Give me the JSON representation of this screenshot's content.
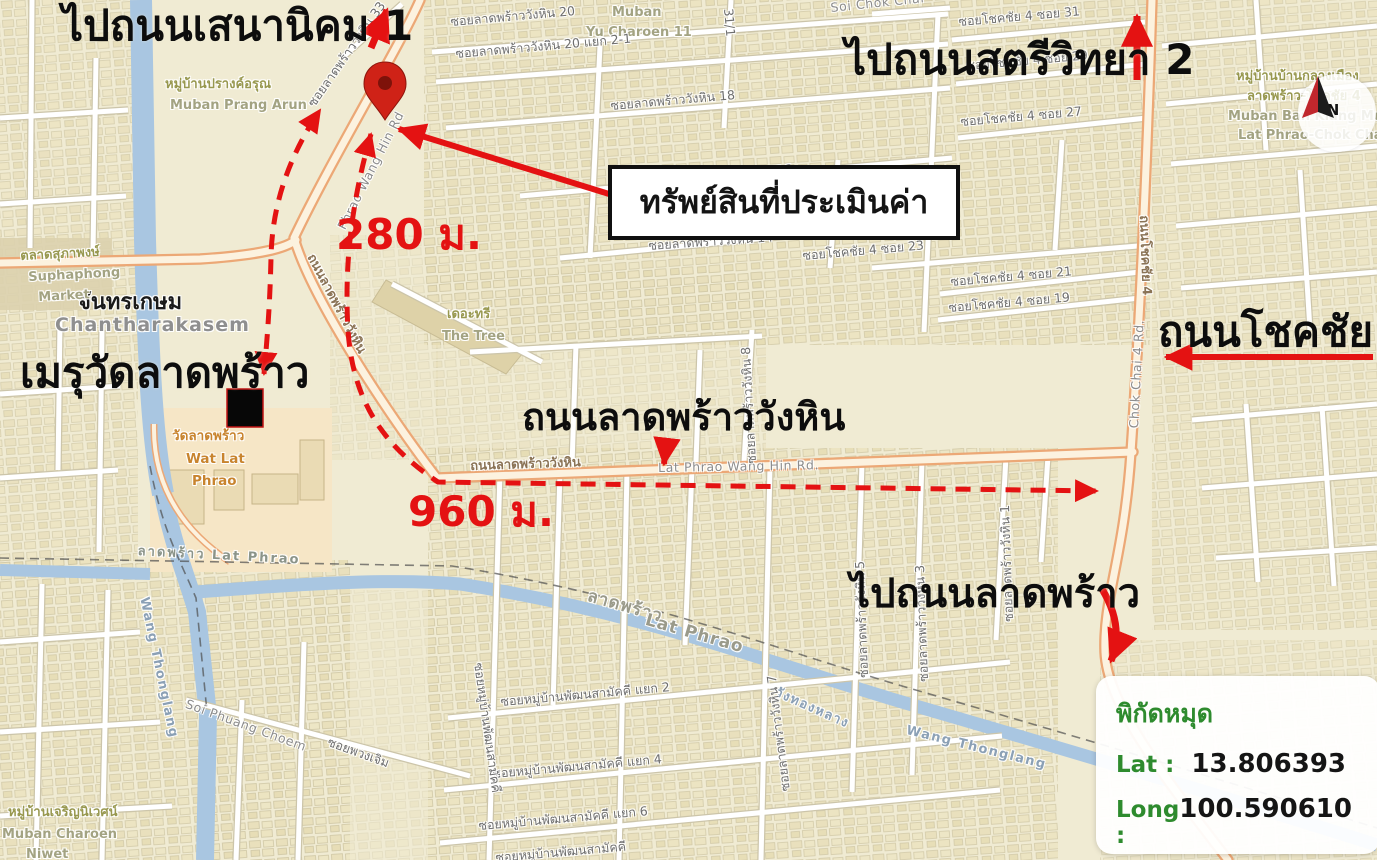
{
  "annotations": {
    "to_sena_nikhom_1": "ไปถนนเสนานิคม 1",
    "to_satri_witthaya_2": "ไปถนนสตรีวิทยา 2",
    "appraised_property": "ทรัพย์สินที่ประเมินค่า",
    "crematorium_wat_lat_phrao": "เมรุวัดลาดพร้าว",
    "lat_phrao_wang_hin_road_big": "ถนนลาดพร้าววังหิน",
    "chok_chai_4_road_big": "ถนนโชคชัย 4",
    "to_lat_phrao_road": "ไปถนนลาดพร้าว",
    "distance_to_crematorium": "280 ม.",
    "distance_to_chok_chai_4": "960 ม."
  },
  "coordinate_panel": {
    "title": "พิกัดหมุด",
    "lat_label": "Lat :",
    "lat_value": "13.806393",
    "long_label": "Long :",
    "long_value": "100.590610"
  },
  "compass": {
    "north_label": "N"
  },
  "colors": {
    "annotation_red": "#e41212",
    "coordinate_green": "#2e8b2e",
    "map_background": "#f0ebd3",
    "canal_blue": "#a9c6e1",
    "main_road_casing": "#eca876",
    "pin_red": "#cf2217"
  },
  "street_labels": [
    {
      "t": "ซอยลาดพร้าววังหิน 20",
      "x": 450,
      "y": 16,
      "r": -5,
      "c": "soi"
    },
    {
      "t": "Muban",
      "x": 612,
      "y": 6,
      "r": 0,
      "c": "area-en"
    },
    {
      "t": "Yu Charoen 11",
      "x": 586,
      "y": 26,
      "r": 0,
      "c": "area-en"
    },
    {
      "t": "ซอยลาดพร้าววังหิน 20 แยก 2-1",
      "x": 455,
      "y": 48,
      "r": -5,
      "c": "soi"
    },
    {
      "t": "ซอยลาดพร้าววังหิน 18",
      "x": 610,
      "y": 100,
      "r": -5,
      "c": "soi"
    },
    {
      "t": "Soi Lat Phrao Wang Hin 16",
      "x": 612,
      "y": 182,
      "r": -6,
      "c": "road-en"
    },
    {
      "t": "ซอยลาดพร้าววังหิน 14",
      "x": 648,
      "y": 240,
      "r": -4,
      "c": "soi"
    },
    {
      "t": "ซอยโชคชัย 4 ซอย 31",
      "x": 958,
      "y": 16,
      "r": -5,
      "c": "soi"
    },
    {
      "t": "ซอยโชคชัย 4 ซอย 29",
      "x": 966,
      "y": 60,
      "r": -5,
      "c": "soi"
    },
    {
      "t": "ซอยโชคชัย 4 ซอย 27",
      "x": 960,
      "y": 116,
      "r": -5,
      "c": "soi"
    },
    {
      "t": "ซอยโชคชัย 4 ซอย 23",
      "x": 802,
      "y": 250,
      "r": -5,
      "c": "soi"
    },
    {
      "t": "ซอยโชคชัย 4 ซอย 21",
      "x": 950,
      "y": 276,
      "r": -5,
      "c": "soi"
    },
    {
      "t": "ซอยโชคชัย 4 ซอย 19",
      "x": 948,
      "y": 302,
      "r": -5,
      "c": "soi"
    },
    {
      "t": "Soi Chok Chai",
      "x": 830,
      "y": 2,
      "r": -6,
      "c": "road-en"
    },
    {
      "t": "31/1",
      "x": 734,
      "y": 8,
      "r": 85,
      "c": "soi"
    },
    {
      "t": "ซอยลาดพร้าววังหิน 33",
      "x": 306,
      "y": 102,
      "r": -55,
      "c": "soi"
    },
    {
      "t": "หมู่บ้านปรางค์อรุณ",
      "x": 165,
      "y": 78,
      "r": 0,
      "c": "area"
    },
    {
      "t": "Muban Prang Arun",
      "x": 170,
      "y": 99,
      "r": 0,
      "c": "area-en"
    },
    {
      "t": "หมู่บ้านบ้านกลางเมือง",
      "x": 1236,
      "y": 70,
      "r": 0,
      "c": "area"
    },
    {
      "t": "ลาดพร้าว-โชคชัย 4",
      "x": 1247,
      "y": 90,
      "r": 0,
      "c": "area"
    },
    {
      "t": "Muban Ban Klang Muang",
      "x": 1228,
      "y": 110,
      "r": 0,
      "c": "area-en"
    },
    {
      "t": "Lat Phrao-Chok Chai",
      "x": 1238,
      "y": 129,
      "r": 0,
      "c": "area-en"
    },
    {
      "t": "ถนนลาดพร้าววังหิน",
      "x": 316,
      "y": 252,
      "r": 62,
      "c": "road-th"
    },
    {
      "t": "Phrao Wang Hin Rd",
      "x": 336,
      "y": 226,
      "r": -63,
      "c": "road-en"
    },
    {
      "t": "ถนนลาดพร้าววังหิน",
      "x": 470,
      "y": 460,
      "r": -2,
      "c": "road-th"
    },
    {
      "t": "Lat Phrao Wang Hin Rd.",
      "x": 658,
      "y": 462,
      "r": -1,
      "c": "road-en"
    },
    {
      "t": "ถนนโชคชัย 4",
      "x": 1150,
      "y": 215,
      "r": 88,
      "c": "road-th"
    },
    {
      "t": "Chok Chai 4 Rd.",
      "x": 1128,
      "y": 428,
      "r": -87,
      "c": "road-en"
    },
    {
      "t": "จันทรเกษม",
      "x": 78,
      "y": 292,
      "r": 0,
      "c": "place-black"
    },
    {
      "t": "Chantharakasem",
      "x": 55,
      "y": 316,
      "r": 0,
      "c": "place-gray"
    },
    {
      "t": "ตลาดสุภาพงษ์",
      "x": 20,
      "y": 250,
      "r": -3,
      "c": "area"
    },
    {
      "t": "Suphaphong",
      "x": 28,
      "y": 271,
      "r": -3,
      "c": "area-en"
    },
    {
      "t": "Market",
      "x": 38,
      "y": 291,
      "r": -3,
      "c": "area-en"
    },
    {
      "t": "เดอะทรี",
      "x": 447,
      "y": 308,
      "r": 0,
      "c": "area"
    },
    {
      "t": "The Tree",
      "x": 442,
      "y": 330,
      "r": 0,
      "c": "area-en"
    },
    {
      "t": "วัดลาดพร้าว",
      "x": 172,
      "y": 430,
      "r": 0,
      "c": "temple"
    },
    {
      "t": "Wat Lat",
      "x": 186,
      "y": 453,
      "r": 0,
      "c": "temple"
    },
    {
      "t": "Phrao",
      "x": 192,
      "y": 475,
      "r": 0,
      "c": "temple"
    },
    {
      "t": "ลาดพร้าว  Lat Phrao",
      "x": 138,
      "y": 545,
      "r": 3,
      "c": "boundary"
    },
    {
      "t": "ลาดพร้าว",
      "x": 590,
      "y": 588,
      "r": 16,
      "c": "boundary-big"
    },
    {
      "t": "Lat Phrao",
      "x": 648,
      "y": 612,
      "r": 16,
      "c": "boundary-big"
    },
    {
      "t": "วังทองหลาง",
      "x": 778,
      "y": 686,
      "r": 24,
      "c": "canal-l"
    },
    {
      "t": "Wang Thonglang",
      "x": 908,
      "y": 724,
      "r": 14,
      "c": "canal-l"
    },
    {
      "t": "Wang Thonglang",
      "x": 150,
      "y": 596,
      "r": 78,
      "c": "canal-l"
    },
    {
      "t": "Soi Phuang Choem",
      "x": 188,
      "y": 698,
      "r": 20,
      "c": "road-en"
    },
    {
      "t": "ซอยพวงเจิม",
      "x": 330,
      "y": 736,
      "r": 20,
      "c": "soi"
    },
    {
      "t": "หมู่บ้านเจริญนิเวศน์",
      "x": 8,
      "y": 806,
      "r": 0,
      "c": "area"
    },
    {
      "t": "Muban Charoen",
      "x": 2,
      "y": 828,
      "r": 0,
      "c": "area-en"
    },
    {
      "t": "Niwet",
      "x": 26,
      "y": 848,
      "r": 0,
      "c": "area-en"
    },
    {
      "t": "ซอยหมู่บ้านพัฒนสามัคคี แยก 2",
      "x": 500,
      "y": 696,
      "r": -5,
      "c": "soi"
    },
    {
      "t": "ซอยหมู่บ้านพัฒนสามัคคี แยก 4",
      "x": 492,
      "y": 768,
      "r": -5,
      "c": "soi"
    },
    {
      "t": "ซอยหมู่บ้านพัฒนสามัคคี แยก 6",
      "x": 478,
      "y": 820,
      "r": -5,
      "c": "soi"
    },
    {
      "t": "ซอยหมู่บ้านพัฒนสามัคคี",
      "x": 484,
      "y": 662,
      "r": 82,
      "c": "soi"
    },
    {
      "t": "ซอยหมู่บ้านพัฒนสามัคคี",
      "x": 495,
      "y": 852,
      "r": -5,
      "c": "soi"
    },
    {
      "t": "ซอยลาดพร้าววังหิน 7",
      "x": 780,
      "y": 792,
      "r": -97,
      "c": "soi"
    },
    {
      "t": "ซอยลาดพร้าววังหิน 5",
      "x": 858,
      "y": 678,
      "r": -92,
      "c": "soi"
    },
    {
      "t": "ซอยลาดพร้าววังหิน 3",
      "x": 918,
      "y": 682,
      "r": -92,
      "c": "soi"
    },
    {
      "t": "ซอยลาดพร้าววังหิน 1",
      "x": 1003,
      "y": 622,
      "r": -92,
      "c": "soi"
    },
    {
      "t": "ซอยลาดพร้าววังหิน 8",
      "x": 746,
      "y": 464,
      "r": -93,
      "c": "soi"
    }
  ]
}
